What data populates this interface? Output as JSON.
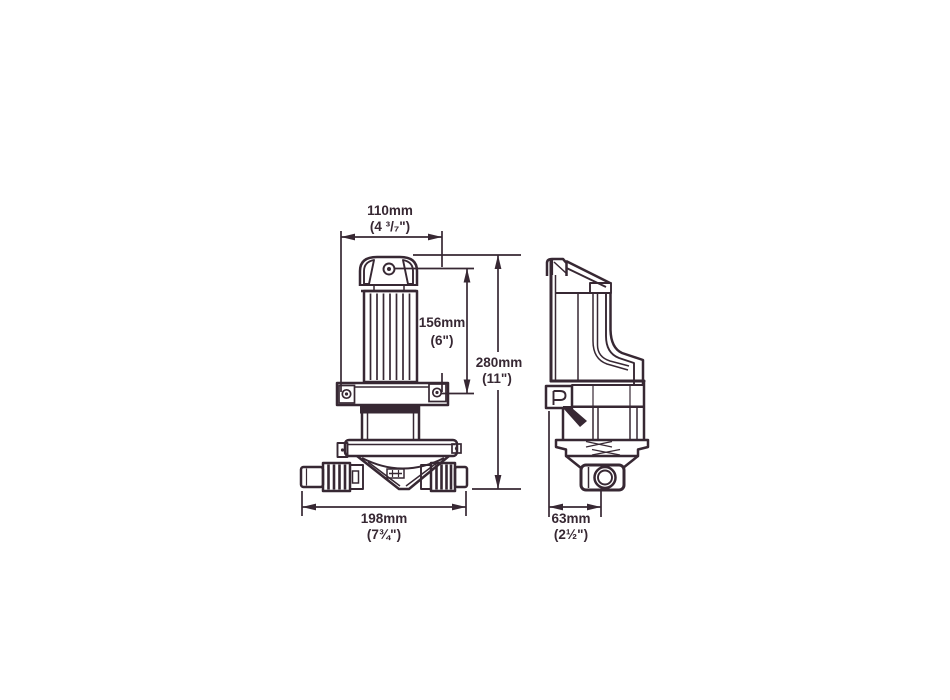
{
  "diagram": {
    "title": "pump dimensional drawing (front and side views)",
    "colors": {
      "ink": "#372833",
      "background": "#ffffff"
    },
    "dimensions": {
      "motor_width": {
        "metric": "110mm",
        "imperial": "(4 ³/₇\")"
      },
      "motor_height": {
        "metric": "156mm",
        "imperial": "(6\")"
      },
      "overall_height": {
        "metric": "280mm",
        "imperial": "(11\")"
      },
      "overall_width": {
        "metric": "198mm",
        "imperial": "(7¾\")"
      },
      "base_depth": {
        "metric": "63mm",
        "imperial": "(2½\")"
      }
    }
  }
}
